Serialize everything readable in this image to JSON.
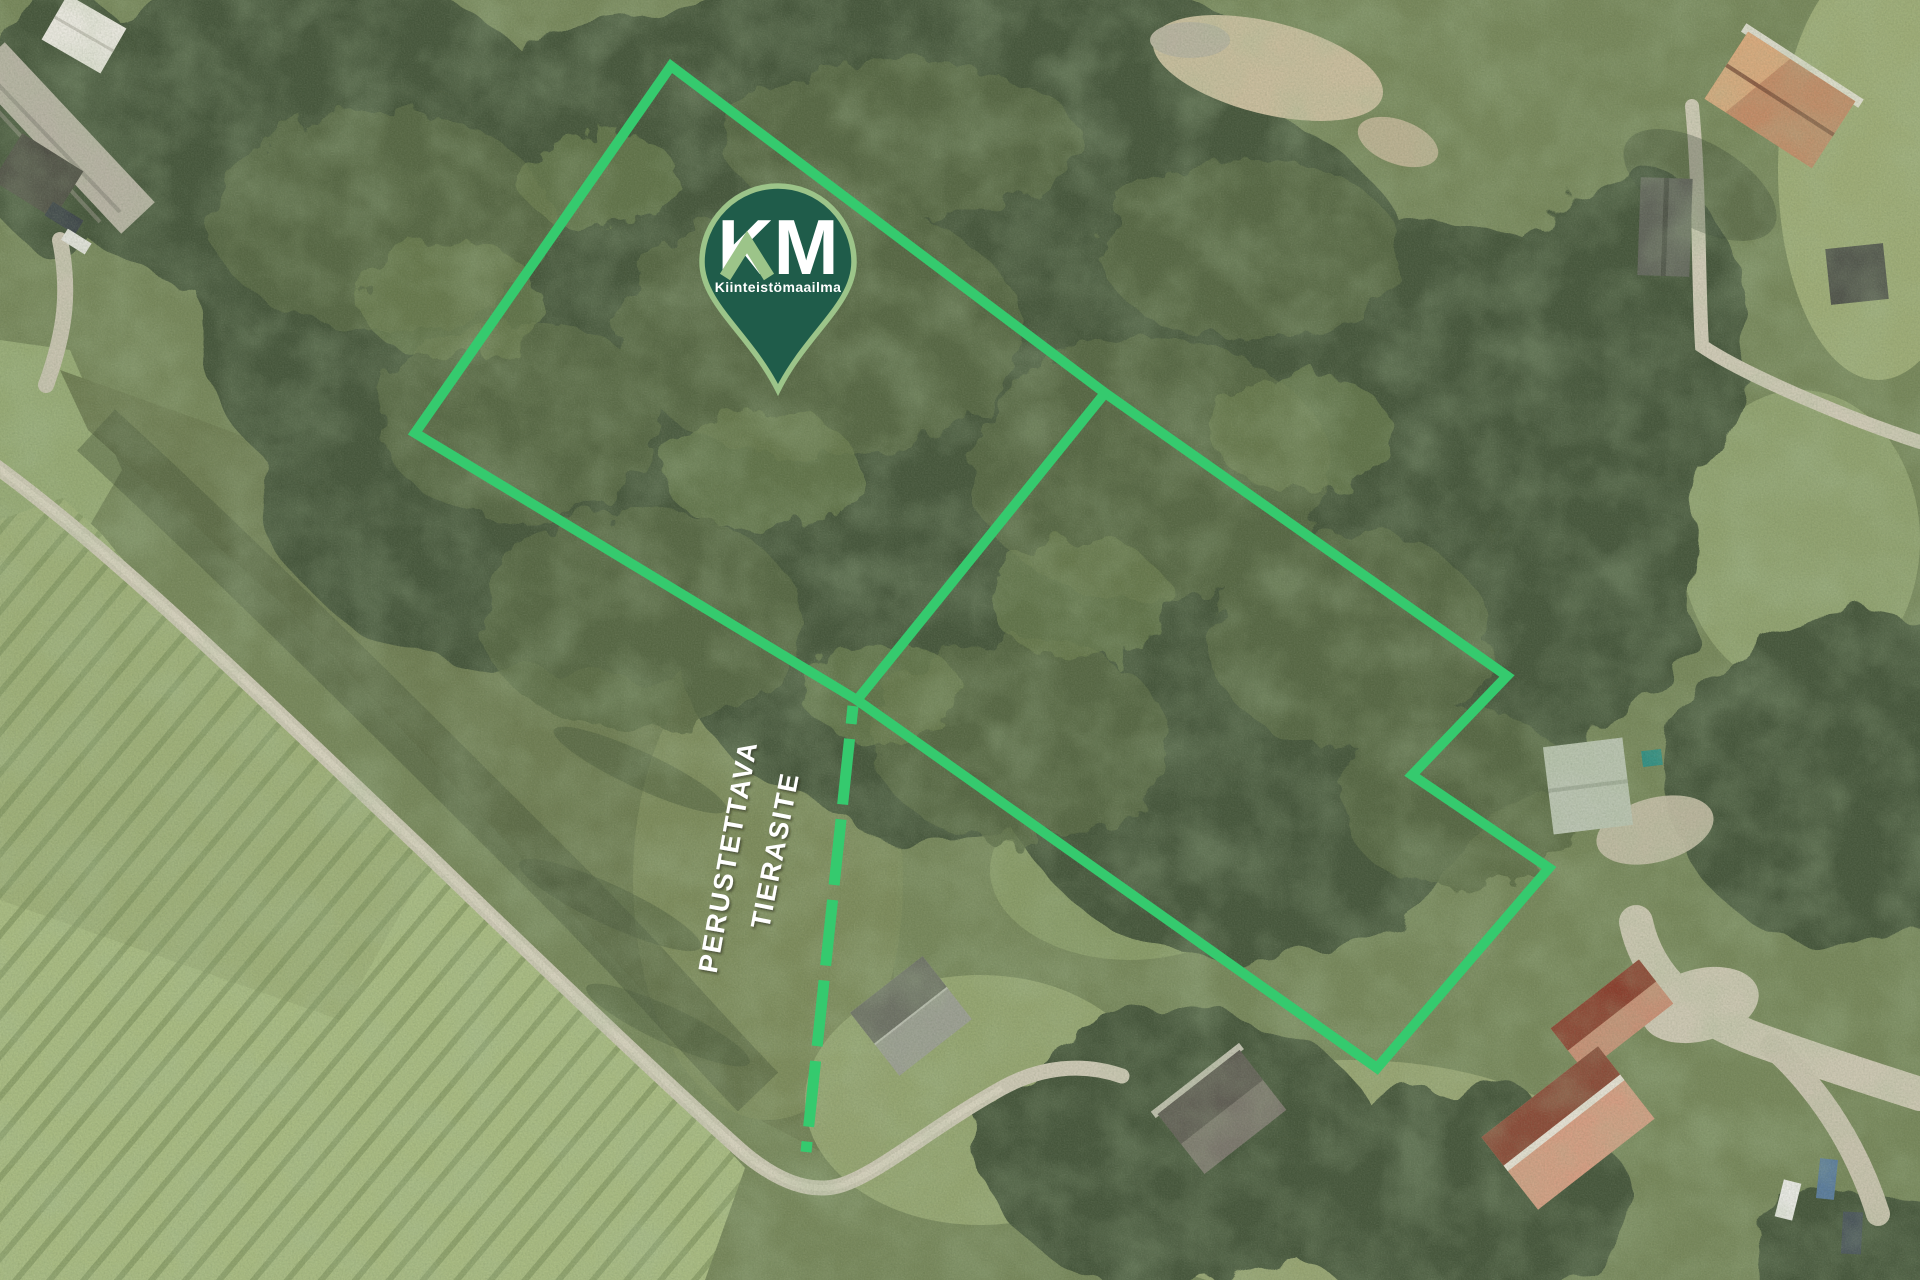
{
  "pin": {
    "initials": "KM",
    "brand_name": "Kiinteistömaailma",
    "anchor_transform": "translate(778,262)",
    "fill": "#1f5c4a",
    "border": "#9cc489",
    "accent": "#9cc489",
    "text_color": "#ffffff"
  },
  "easement_label": {
    "line1": "PERUSTETTAVA",
    "line2": "TIERASITE",
    "color": "#ffffff",
    "line1_transform": "translate(737,858) rotate(-80)",
    "line2_transform": "translate(784,852) rotate(-79)"
  },
  "boundary": {
    "color": "#35ca6e",
    "outer_points": "671,66 1105,393 1507,676 1412,775 1549,868 1377,1068 857,700 415,433",
    "divider_points": "1105,393 857,700",
    "easement_points": "853,706 806,1152",
    "solid_width": "10",
    "dashed_width": "11",
    "dash_pattern": "66 15"
  }
}
